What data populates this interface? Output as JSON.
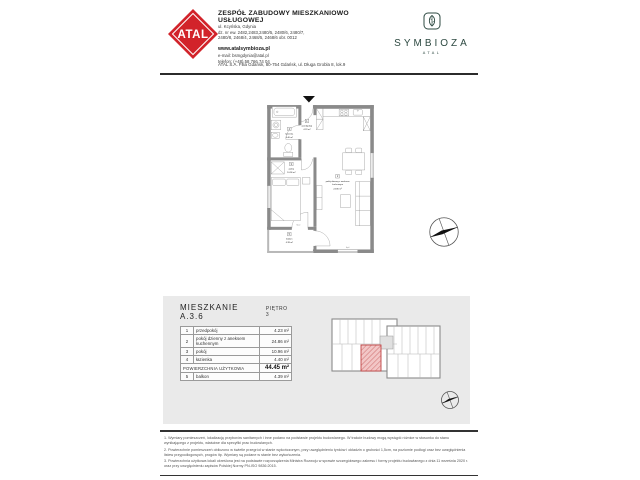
{
  "header": {
    "logo_text": "ATAL",
    "project_title": "ZESPÓŁ ZABUDOWY MIESZKANIOWO USŁUGOWEJ",
    "address": "ul. Kcyńska, Gdynia",
    "plots_line1": "dz. nr ew. 2482,2483,2480/5, 2480/6, 2480/7,",
    "plots_line2": "2480/8, 2468/4, 2468/5, 2468/6  obr. 0012",
    "website": "www.atalsymbioza.pl",
    "email": "e-mail: bsmgdynia@atal.pl",
    "phone": "telefon: (+48) 58 766 74 04",
    "branch": "ATAL S.A. Filia Gdańsk, 80-754 Gdańsk, ul. Długa Grobla 8, lok.9",
    "brand": {
      "name": "SYMBIOZA",
      "sub": "ATAL"
    }
  },
  "plan": {
    "labels": {
      "hall_no": "1",
      "hall_name": "przedpokój",
      "hall_area": "4.23 m²",
      "living_no": "2",
      "living_name_line1": "pokój dzienny z aneksem",
      "living_name_line2": "kuchennym",
      "living_area": "24.86 m²",
      "bedroom_no": "3",
      "bedroom_name": "pokój",
      "bedroom_area": "10.96 m²",
      "bath_no": "4",
      "bath_name": "łazienka",
      "bath_area": "4.40 m²",
      "balcony_no": "5",
      "balcony_name": "balkon",
      "balcony_area": "4.39 m²"
    },
    "annotations": {
      "a1": "Hp=0",
      "a2": "Hp=0"
    }
  },
  "apartment": {
    "title_label": "MIESZKANIE",
    "unit_number": "A.3.6",
    "floor_label": "PIĘTRO 3",
    "rooms": [
      {
        "no": "1",
        "name": "przedpokój",
        "area": "4.23 m²"
      },
      {
        "no": "2",
        "name": "pokój dzienny z aneksem kuchennym",
        "area": "24.86 m²"
      },
      {
        "no": "3",
        "name": "pokój",
        "area": "10.96 m²"
      },
      {
        "no": "4",
        "name": "łazienka",
        "area": "4.40 m²"
      }
    ],
    "total_label": "POWIERZCHNIA UŻYTKOWA",
    "total_area": "44.45 m²",
    "extra_room": {
      "no": "5",
      "name": "balkon",
      "area": "4.39 m²"
    }
  },
  "disclaimer": {
    "item1": "1. Wymiary pomieszczeń, lokalizację przyborów sanitarnych i inne podano na podstawie projektu budowlanego. W trakcie budowy mogą wystąpić różnice w stosunku do stanu wynikającego z projektu, właściwe dla specyfiki prac budowlanych.",
    "item2": "2. Powierzchnie pomieszczeń obliczono w świetle przegród w stanie wykończonym, przy uwzględnieniu tynków i okładzin o grubości 1,5cm, na poziomie podłogi oraz bez uwzględnienia listew przypodłogowych, progów itp. Wymiary są podane w stanie bez wykończenia.",
    "item3": "3. Powierzchnia użytkowa lokali określona jest na podstawie rozporządzenia Ministra Rozwoju w sprawie szczegółowego zakresu i formy projektu budowlanego z dnia 11 września 2020 r. oraz przy uwzględnieniu zapisów Polskiej Normy PN-ISO 9836:2015."
  },
  "colors": {
    "atal_red": "#d2232a",
    "brand_teal": "#2e4a42",
    "wall_gray": "#8a8a8a",
    "panel_gray": "#eaeaea",
    "unit_highlight": "#f2c6c6",
    "unit_border": "#c04444"
  }
}
